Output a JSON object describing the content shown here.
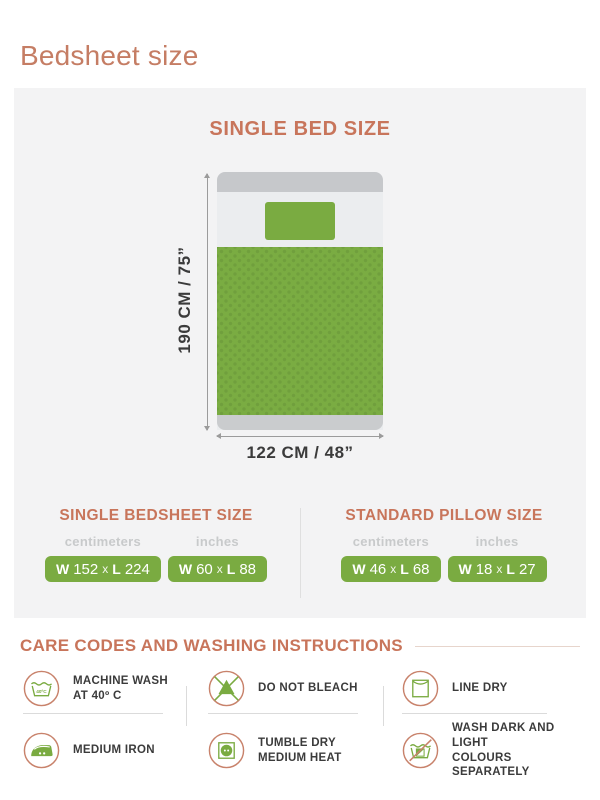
{
  "page_title": "Bedsheet size",
  "colors": {
    "accent_coral": "#C8755B",
    "green": "#7AAB41",
    "panel_bg": "#F3F3F4",
    "dark_text": "#3B3B3B",
    "muted_label": "#C8CACB"
  },
  "diagram": {
    "heading": "SINGLE BED SIZE",
    "height_label": "190 CM / 75”",
    "width_label": "122 CM / 48”"
  },
  "size_tables": {
    "shared": {
      "w_label": "W",
      "x_label": "x",
      "l_label": "L"
    },
    "bedsheet": {
      "heading": "SINGLE BEDSHEET SIZE",
      "columns": [
        {
          "unit": "centimeters",
          "w": "152",
          "l": "224"
        },
        {
          "unit": "inches",
          "w": "60",
          "l": "88"
        }
      ]
    },
    "pillow": {
      "heading": "STANDARD PILLOW SIZE",
      "columns": [
        {
          "unit": "centimeters",
          "w": "46",
          "l": "68"
        },
        {
          "unit": "inches",
          "w": "18",
          "l": "27"
        }
      ]
    }
  },
  "care": {
    "heading": "CARE CODES AND WASHING INSTRUCTIONS",
    "wash_temp_badge": "40ºC",
    "items": [
      {
        "icon": "machine-wash-icon",
        "line1": "MACHINE WASH",
        "line2": "AT  40º C"
      },
      {
        "icon": "medium-iron-icon",
        "line1": "MEDIUM IRON",
        "line2": ""
      },
      {
        "icon": "do-not-bleach-icon",
        "line1": "DO NOT BLEACH",
        "line2": ""
      },
      {
        "icon": "tumble-dry-icon",
        "line1": "TUMBLE DRY",
        "line2": "MEDIUM HEAT"
      },
      {
        "icon": "line-dry-icon",
        "line1": "LINE DRY",
        "line2": ""
      },
      {
        "icon": "wash-separately-icon",
        "line1": "WASH DARK AND LIGHT",
        "line2": "COLOURS SEPARATELY"
      }
    ]
  }
}
